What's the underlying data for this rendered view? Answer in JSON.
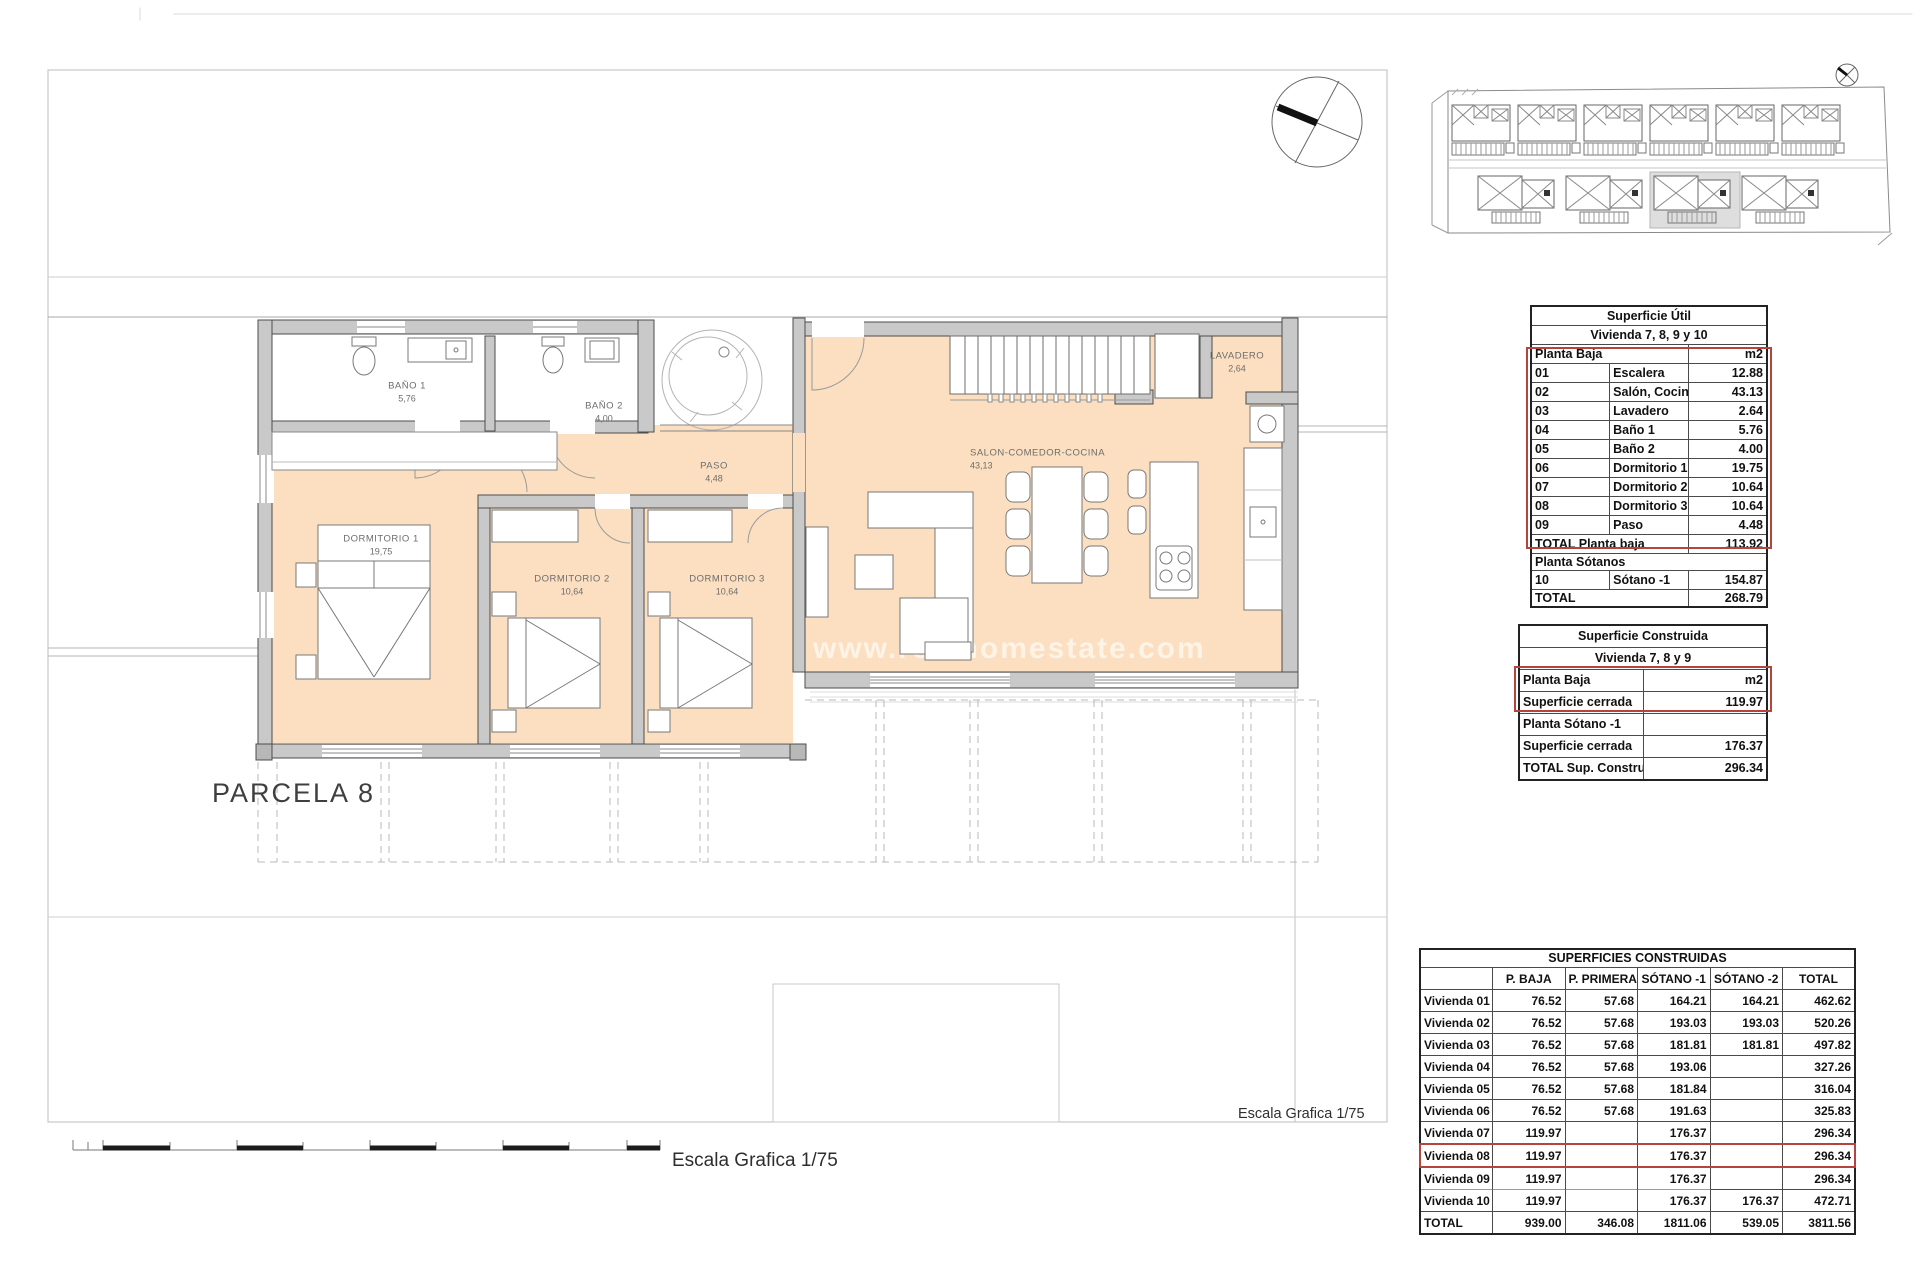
{
  "plan": {
    "parcel_label": "PARCELA 8",
    "watermark": "www.realhomestate.com",
    "scale_label_bottom": "Escala Grafica 1/75",
    "scale_label_plan": "Escala Grafica 1/75",
    "rooms": [
      {
        "name": "BAÑO 1",
        "area": "5,76"
      },
      {
        "name": "BAÑO 2",
        "area": "4,00"
      },
      {
        "name": "PASO",
        "area": "4,48"
      },
      {
        "name": "DORMITORIO 1",
        "area": "19,75"
      },
      {
        "name": "DORMITORIO 2",
        "area": "10,64"
      },
      {
        "name": "DORMITORIO 3",
        "area": "10,64"
      },
      {
        "name": "SALON-COMEDOR-COCINA",
        "area": "43,13"
      },
      {
        "name": "LAVADERO",
        "area": "2,64"
      }
    ],
    "colors": {
      "floor": "#fbdfc0",
      "wall_fill": "#c9c9c9",
      "wall_stroke": "#4d4d4d",
      "highlight_red": "#b5443c"
    }
  },
  "tables": {
    "superficie_util": {
      "title": "Superficie Útil",
      "subtitle": "Vivienda 7, 8, 9 y 10",
      "header_label": "Planta Baja",
      "header_unit": "m2",
      "rows": [
        {
          "cells": [
            "01",
            "Escalera",
            "12.88"
          ]
        },
        {
          "cells": [
            "02",
            "Salón, Cocina, Comedor",
            "43.13"
          ]
        },
        {
          "cells": [
            "03",
            "Lavadero",
            "2.64"
          ]
        },
        {
          "cells": [
            "04",
            "Baño 1",
            "5.76"
          ]
        },
        {
          "cells": [
            "05",
            "Baño 2",
            "4.00"
          ]
        },
        {
          "cells": [
            "06",
            "Dormitorio 1",
            "19.75"
          ]
        },
        {
          "cells": [
            "07",
            "Dormitorio 2",
            "10.64"
          ]
        },
        {
          "cells": [
            "08",
            "Dormitorio 3",
            "10.64"
          ]
        },
        {
          "cells": [
            "09",
            "Paso",
            "4.48"
          ]
        }
      ],
      "total_planta_baja_label": "TOTAL Planta baja",
      "total_planta_baja_value": "113.92",
      "section2_label": "Planta Sótanos",
      "sotano_row": {
        "cells": [
          "10",
          "Sótano -1",
          "154.87"
        ]
      },
      "total_label": "TOTAL",
      "total_value": "268.79"
    },
    "superficie_construida": {
      "title": "Superficie Construida",
      "subtitle": "Vivienda 7, 8 y 9",
      "rows": [
        {
          "cells": [
            "Planta Baja",
            "m2"
          ]
        },
        {
          "cells": [
            "Superficie cerrada",
            "119.97"
          ]
        },
        {
          "cells": [
            "Planta Sótano -1",
            ""
          ]
        },
        {
          "cells": [
            "Superficie cerrada",
            "176.37"
          ]
        },
        {
          "cells": [
            "TOTAL Sup. Construida",
            "296.34"
          ]
        }
      ]
    },
    "superficies_construidas": {
      "title": "SUPERFICIES CONSTRUIDAS",
      "columns": [
        "",
        "P. BAJA",
        "P. PRIMERA",
        "SÓTANO -1",
        "SÓTANO -2",
        "TOTAL"
      ],
      "rows": [
        {
          "cells": [
            "Vivienda 01",
            "76.52",
            "57.68",
            "164.21",
            "164.21",
            "462.62"
          ]
        },
        {
          "cells": [
            "Vivienda 02",
            "76.52",
            "57.68",
            "193.03",
            "193.03",
            "520.26"
          ]
        },
        {
          "cells": [
            "Vivienda 03",
            "76.52",
            "57.68",
            "181.81",
            "181.81",
            "497.82"
          ]
        },
        {
          "cells": [
            "Vivienda 04",
            "76.52",
            "57.68",
            "193.06",
            "",
            "327.26"
          ]
        },
        {
          "cells": [
            "Vivienda 05",
            "76.52",
            "57.68",
            "181.84",
            "",
            "316.04"
          ]
        },
        {
          "cells": [
            "Vivienda 06",
            "76.52",
            "57.68",
            "191.63",
            "",
            "325.83"
          ]
        },
        {
          "cells": [
            "Vivienda 07",
            "119.97",
            "",
            "176.37",
            "",
            "296.34"
          ]
        },
        {
          "cells": [
            "Vivienda 08",
            "119.97",
            "",
            "176.37",
            "",
            "296.34"
          ],
          "_class": "highlight"
        },
        {
          "cells": [
            "Vivienda 09",
            "119.97",
            "",
            "176.37",
            "",
            "296.34"
          ],
          "_class": "partial-red"
        },
        {
          "cells": [
            "Vivienda 10",
            "119.97",
            "",
            "176.37",
            "176.37",
            "472.71"
          ]
        },
        {
          "cells": [
            "TOTAL",
            "939.00",
            "346.08",
            "1811.06",
            "539.05",
            "3811.56"
          ]
        }
      ]
    }
  }
}
